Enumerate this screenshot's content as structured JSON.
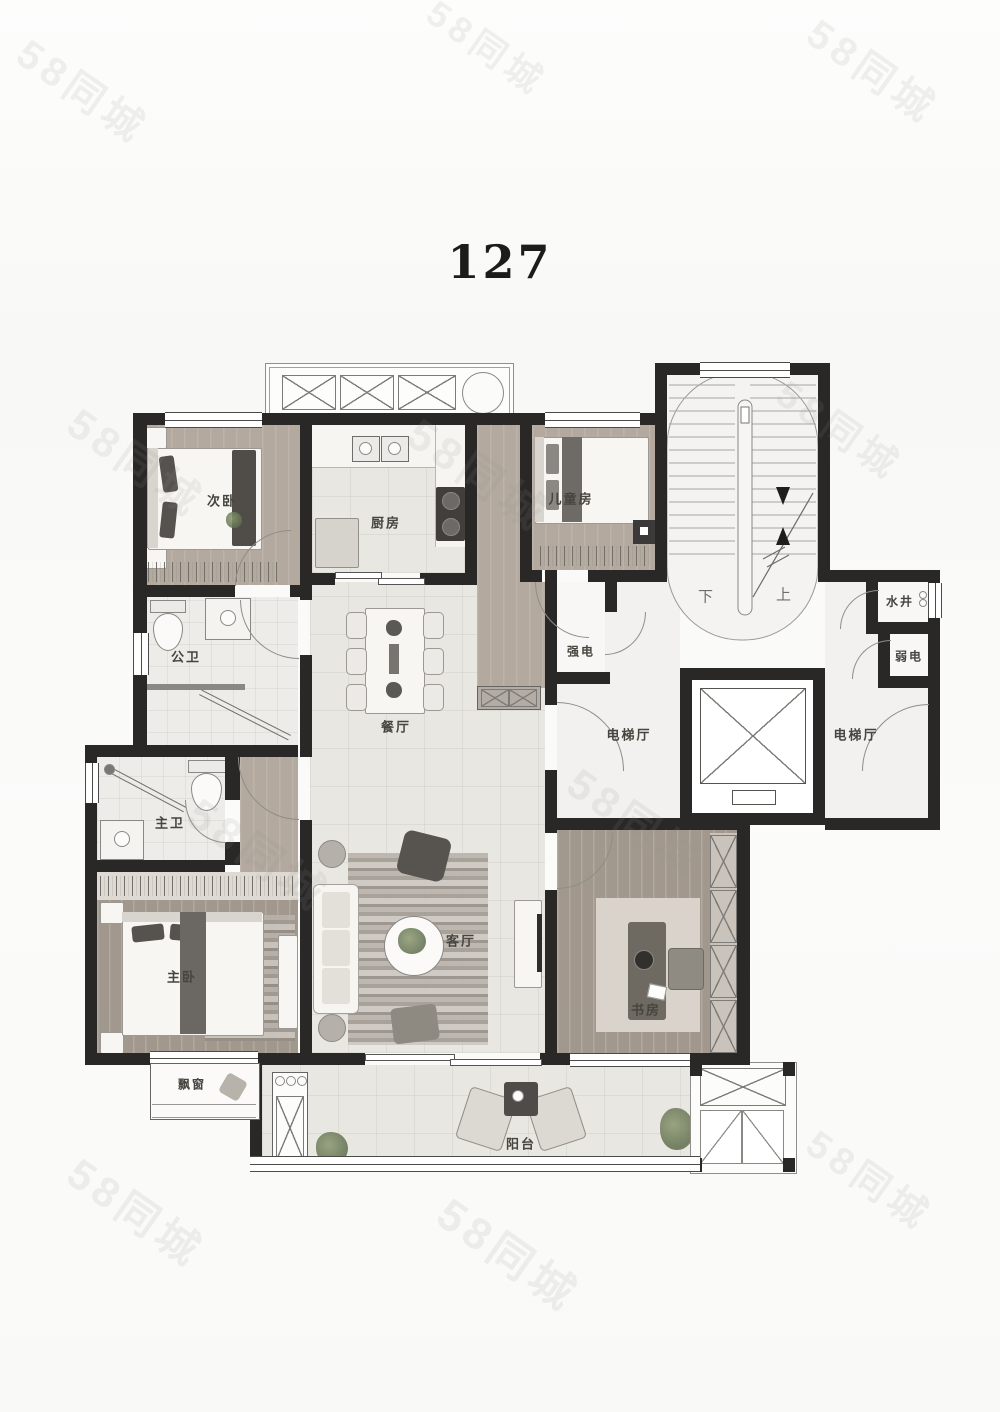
{
  "title": "127",
  "watermark": {
    "text": "58同城"
  },
  "labels": {
    "secondary_bedroom": "次卧",
    "kitchen": "厨房",
    "children_room": "儿童房",
    "guest_bathroom": "公卫",
    "master_bathroom": "主卫",
    "master_bedroom": "主卧",
    "dining_room": "餐厅",
    "living_room": "客厅",
    "study": "书房",
    "balcony": "阳台",
    "bay_window": "飘窗",
    "strong_electric": "强电",
    "weak_electric": "弱电",
    "water_shaft": "水井",
    "elevator_hall_left": "电梯厅",
    "elevator_hall_right": "电梯厅",
    "stair_down": "下",
    "stair_up": "上"
  },
  "colors": {
    "wall": "#2a2826",
    "wood_floor": "#b3a99e",
    "tile_floor": "#e9e7e2",
    "hall_floor": "#f2f1ef",
    "paper": "#fbfbfa"
  }
}
